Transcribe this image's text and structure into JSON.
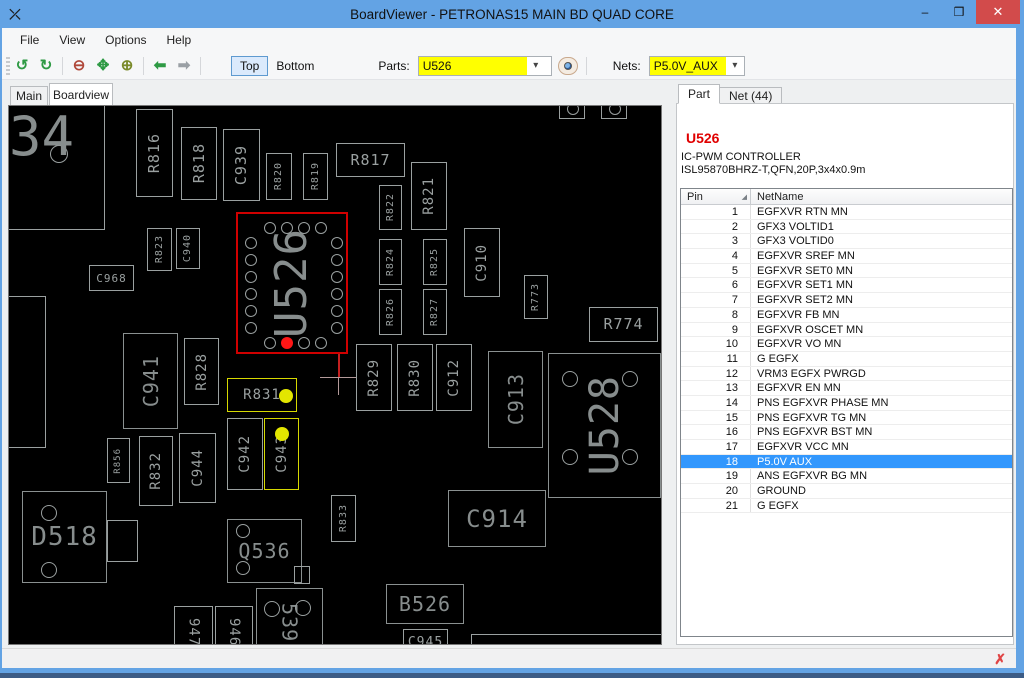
{
  "window": {
    "title": "BoardViewer  -  PETRONAS15 MAIN BD QUAD CORE",
    "app_icon": "⤫",
    "minimize": "–",
    "maximize": "❒",
    "close": "✕"
  },
  "menu": {
    "items": [
      "File",
      "View",
      "Options",
      "Help"
    ]
  },
  "toolbar": {
    "rotate_ccw": "↺",
    "rotate_cw": "↻",
    "zoom_out": "⊖",
    "zoom_fit": "✥",
    "zoom_in": "⊕",
    "back_arrow": "⬅",
    "forward_arrow": "➡",
    "top_label": "Top",
    "bottom_label": "Bottom",
    "parts_label": "Parts:",
    "parts_value": "U526",
    "parts_chevron": "▾",
    "nets_label": "Nets:",
    "nets_value": "P5.0V_AUX",
    "nets_chevron": "▾",
    "highlight_color": "#ffff00"
  },
  "view_tabs": {
    "items": [
      "Main",
      "Boardview"
    ],
    "active": "Boardview"
  },
  "panel": {
    "tabs": [
      "Part",
      "Net (44)"
    ],
    "active_tab": "Part",
    "part_ref": "U526",
    "part_ref_color": "#e00000",
    "desc_line1": "IC-PWM CONTROLLER",
    "desc_line2": "ISL95870BHRZ-T,QFN,20P,3x4x0.9m",
    "table": {
      "col_pin": "Pin",
      "col_net": "NetName",
      "sort_glyph": "◢",
      "selected_row_color": "#3297fd"
    },
    "pins": [
      {
        "pin": "1",
        "net": "EGFXVR RTN MN"
      },
      {
        "pin": "2",
        "net": "GFX3 VOLTID1"
      },
      {
        "pin": "3",
        "net": "GFX3 VOLTID0"
      },
      {
        "pin": "4",
        "net": "EGFXVR SREF MN"
      },
      {
        "pin": "5",
        "net": "EGFXVR SET0 MN"
      },
      {
        "pin": "6",
        "net": "EGFXVR SET1 MN"
      },
      {
        "pin": "7",
        "net": "EGFXVR SET2 MN"
      },
      {
        "pin": "8",
        "net": "EGFXVR FB MN"
      },
      {
        "pin": "9",
        "net": "EGFXVR OSCET MN"
      },
      {
        "pin": "10",
        "net": "EGFXVR VO MN"
      },
      {
        "pin": "11",
        "net": "G EGFX"
      },
      {
        "pin": "12",
        "net": "VRM3 EGFX PWRGD"
      },
      {
        "pin": "13",
        "net": "EGFXVR EN MN"
      },
      {
        "pin": "14",
        "net": "PNS EGFXVR PHASE MN"
      },
      {
        "pin": "15",
        "net": "PNS EGFXVR TG MN"
      },
      {
        "pin": "16",
        "net": "PNS EGFXVR BST MN"
      },
      {
        "pin": "17",
        "net": "EGFXVR VCC MN"
      },
      {
        "pin": "18",
        "net": "P5.0V AUX",
        "selected": true
      },
      {
        "pin": "19",
        "net": "ANS EGFXVR BG MN"
      },
      {
        "pin": "20",
        "net": "GROUND"
      },
      {
        "pin": "21",
        "net": "G EGFX"
      }
    ]
  },
  "statusbar": {
    "close_icon": "✗"
  },
  "board": {
    "selected_part_color": "#cf0000",
    "net_highlight_color": "#d6d900",
    "texts": [
      {
        "t": "34",
        "x": 0,
        "y": 4,
        "fs": 54
      }
    ],
    "crosshair": {
      "x": 329,
      "y": 271,
      "arm": 18
    },
    "redline": {
      "x": 329,
      "y1": 248,
      "y2": 271
    },
    "components": [
      {
        "id": "edge-outline-tl",
        "x": -30,
        "y": -30,
        "w": 126,
        "h": 154,
        "circles": [
          [
            79,
            77,
            9
          ]
        ]
      },
      {
        "id": "edge-outline-left",
        "x": -20,
        "y": 190,
        "w": 57,
        "h": 152
      },
      {
        "id": "R816",
        "label": "R816",
        "x": 127,
        "y": 3,
        "w": 37,
        "h": 88,
        "o": "v",
        "fs": 15
      },
      {
        "id": "R818",
        "label": "R818",
        "x": 172,
        "y": 21,
        "w": 36,
        "h": 73,
        "o": "v",
        "fs": 15
      },
      {
        "id": "C939",
        "label": "C939",
        "x": 214,
        "y": 23,
        "w": 37,
        "h": 72,
        "o": "v",
        "fs": 15
      },
      {
        "id": "R820",
        "label": "R820",
        "x": 257,
        "y": 47,
        "w": 26,
        "h": 47,
        "o": "v",
        "fs": 10
      },
      {
        "id": "R819",
        "label": "R819",
        "x": 294,
        "y": 47,
        "w": 25,
        "h": 47,
        "o": "v",
        "fs": 10
      },
      {
        "id": "R817",
        "label": "R817",
        "x": 327,
        "y": 37,
        "w": 69,
        "h": 34,
        "o": "h",
        "fs": 15
      },
      {
        "id": "R822",
        "label": "R822",
        "x": 370,
        "y": 79,
        "w": 23,
        "h": 45,
        "o": "v",
        "fs": 10
      },
      {
        "id": "R821",
        "label": "R821",
        "x": 402,
        "y": 56,
        "w": 36,
        "h": 68,
        "o": "v",
        "fs": 14
      },
      {
        "id": "R823",
        "label": "R823",
        "x": 138,
        "y": 122,
        "w": 25,
        "h": 43,
        "o": "v",
        "fs": 10
      },
      {
        "id": "C940",
        "label": "C940",
        "x": 167,
        "y": 122,
        "w": 24,
        "h": 41,
        "o": "v",
        "fs": 10
      },
      {
        "id": "C968",
        "label": "C968",
        "x": 80,
        "y": 159,
        "w": 45,
        "h": 26,
        "o": "h",
        "fs": 11
      },
      {
        "id": "U526",
        "label": "U526",
        "x": 227,
        "y": 106,
        "w": 112,
        "h": 142,
        "o": "v",
        "fs": 44,
        "big": true,
        "hl": "red",
        "circles": [
          [
            13,
            29,
            6
          ],
          [
            13,
            46,
            6
          ],
          [
            13,
            63,
            6
          ],
          [
            13,
            80,
            6
          ],
          [
            13,
            97,
            6
          ],
          [
            13,
            114,
            6
          ],
          [
            32,
            14,
            6
          ],
          [
            49,
            14,
            6
          ],
          [
            66,
            14,
            6
          ],
          [
            83,
            14,
            6
          ],
          [
            99,
            29,
            6
          ],
          [
            99,
            46,
            6
          ],
          [
            99,
            63,
            6
          ],
          [
            99,
            80,
            6
          ],
          [
            99,
            97,
            6
          ],
          [
            99,
            114,
            6
          ],
          [
            32,
            129,
            6
          ],
          [
            66,
            129,
            6
          ],
          [
            83,
            129,
            6
          ]
        ],
        "dots": [
          [
            49,
            129,
            6,
            "#ff1616"
          ]
        ]
      },
      {
        "id": "R824",
        "label": "R824",
        "x": 370,
        "y": 133,
        "w": 23,
        "h": 46,
        "o": "v",
        "fs": 10
      },
      {
        "id": "R825",
        "label": "R825",
        "x": 414,
        "y": 133,
        "w": 24,
        "h": 46,
        "o": "v",
        "fs": 10
      },
      {
        "id": "R826",
        "label": "R826",
        "x": 370,
        "y": 183,
        "w": 23,
        "h": 46,
        "o": "v",
        "fs": 10
      },
      {
        "id": "R827",
        "label": "R827",
        "x": 414,
        "y": 183,
        "w": 24,
        "h": 46,
        "o": "v",
        "fs": 10
      },
      {
        "id": "C910",
        "label": "C910",
        "x": 455,
        "y": 122,
        "w": 36,
        "h": 69,
        "o": "v",
        "fs": 14
      },
      {
        "id": "R773",
        "label": "R773",
        "x": 515,
        "y": 169,
        "w": 24,
        "h": 44,
        "o": "v",
        "fs": 10
      },
      {
        "id": "R774",
        "label": "R774",
        "x": 580,
        "y": 201,
        "w": 69,
        "h": 35,
        "o": "h",
        "fs": 15
      },
      {
        "id": "pad-top-1",
        "x": 550,
        "y": -4,
        "w": 26,
        "h": 17,
        "circles": [
          [
            13,
            6,
            6
          ]
        ]
      },
      {
        "id": "pad-top-2",
        "x": 592,
        "y": -4,
        "w": 26,
        "h": 17,
        "circles": [
          [
            13,
            6,
            6
          ]
        ]
      },
      {
        "id": "C941",
        "label": "C941",
        "x": 114,
        "y": 227,
        "w": 55,
        "h": 96,
        "o": "v",
        "fs": 20,
        "big": true
      },
      {
        "id": "R828",
        "label": "R828",
        "x": 175,
        "y": 232,
        "w": 35,
        "h": 67,
        "o": "v",
        "fs": 14
      },
      {
        "id": "R831",
        "label": "R831",
        "x": 218,
        "y": 272,
        "w": 70,
        "h": 34,
        "o": "h",
        "fs": 14,
        "hl": "yellow",
        "dots": [
          [
            58,
            17,
            7,
            "#e3e600"
          ]
        ]
      },
      {
        "id": "C942",
        "label": "C942",
        "x": 218,
        "y": 312,
        "w": 36,
        "h": 72,
        "o": "v",
        "fs": 14
      },
      {
        "id": "C943",
        "label": "C943",
        "x": 255,
        "y": 312,
        "w": 35,
        "h": 72,
        "o": "v",
        "fs": 14,
        "hl": "yellow",
        "dots": [
          [
            17,
            15,
            7,
            "#e3e600"
          ]
        ]
      },
      {
        "id": "R856",
        "label": "R856",
        "x": 98,
        "y": 332,
        "w": 23,
        "h": 45,
        "o": "v",
        "fs": 9
      },
      {
        "id": "R832",
        "label": "R832",
        "x": 130,
        "y": 330,
        "w": 34,
        "h": 70,
        "o": "v",
        "fs": 14
      },
      {
        "id": "C944",
        "label": "C944",
        "x": 170,
        "y": 327,
        "w": 37,
        "h": 70,
        "o": "v",
        "fs": 14
      },
      {
        "id": "R829",
        "label": "R829",
        "x": 347,
        "y": 238,
        "w": 36,
        "h": 67,
        "o": "v",
        "fs": 14
      },
      {
        "id": "R830",
        "label": "R830",
        "x": 388,
        "y": 238,
        "w": 36,
        "h": 67,
        "o": "v",
        "fs": 14
      },
      {
        "id": "C912",
        "label": "C912",
        "x": 427,
        "y": 238,
        "w": 36,
        "h": 67,
        "o": "v",
        "fs": 14
      },
      {
        "id": "C913",
        "label": "C913",
        "x": 479,
        "y": 245,
        "w": 55,
        "h": 97,
        "o": "v",
        "fs": 20,
        "big": true
      },
      {
        "id": "U528",
        "label": "U528",
        "x": 539,
        "y": 247,
        "w": 113,
        "h": 145,
        "o": "v",
        "fs": 40,
        "big": true,
        "circles": [
          [
            21,
            25,
            8
          ],
          [
            81,
            25,
            8
          ],
          [
            21,
            103,
            8
          ],
          [
            81,
            103,
            8
          ]
        ]
      },
      {
        "id": "R833",
        "label": "R833",
        "x": 322,
        "y": 389,
        "w": 25,
        "h": 47,
        "o": "v",
        "fs": 10
      },
      {
        "id": "C914",
        "label": "C914",
        "x": 439,
        "y": 384,
        "w": 98,
        "h": 57,
        "o": "h",
        "fs": 24,
        "big": true
      },
      {
        "id": "D518",
        "label": "D518",
        "x": 13,
        "y": 385,
        "w": 85,
        "h": 92,
        "o": "h",
        "fs": 26,
        "big": true,
        "circles": [
          [
            26,
            21,
            8
          ],
          [
            26,
            78,
            8
          ]
        ],
        "extras": [
          [
            84,
            28,
            31,
            42
          ]
        ]
      },
      {
        "id": "Q536",
        "label": "Q536",
        "x": 218,
        "y": 413,
        "w": 75,
        "h": 64,
        "o": "h",
        "fs": 20,
        "big": true,
        "circles": [
          [
            15,
            11,
            7
          ],
          [
            15,
            48,
            7
          ]
        ],
        "extras": [
          [
            66,
            46,
            16,
            18
          ]
        ]
      },
      {
        "id": "947",
        "label": "947",
        "x": 165,
        "y": 500,
        "w": 39,
        "h": 52,
        "o": "v",
        "fs": 14,
        "dir": "down"
      },
      {
        "id": "946",
        "label": "946",
        "x": 206,
        "y": 500,
        "w": 38,
        "h": 52,
        "o": "v",
        "fs": 14,
        "dir": "down"
      },
      {
        "id": "539",
        "label": "539",
        "x": 247,
        "y": 482,
        "w": 67,
        "h": 70,
        "o": "v",
        "fs": 20,
        "big": true,
        "dir": "down",
        "circles": [
          [
            15,
            20,
            8
          ],
          [
            46,
            19,
            8
          ]
        ]
      },
      {
        "id": "B526",
        "label": "B526",
        "x": 377,
        "y": 478,
        "w": 78,
        "h": 40,
        "o": "h",
        "fs": 20,
        "big": true
      },
      {
        "id": "C945",
        "label": "C945",
        "x": 394,
        "y": 523,
        "w": 45,
        "h": 26,
        "o": "h",
        "fs": 13
      },
      {
        "id": "edge-outline-br",
        "x": 462,
        "y": 528,
        "w": 240,
        "h": 40
      }
    ]
  }
}
